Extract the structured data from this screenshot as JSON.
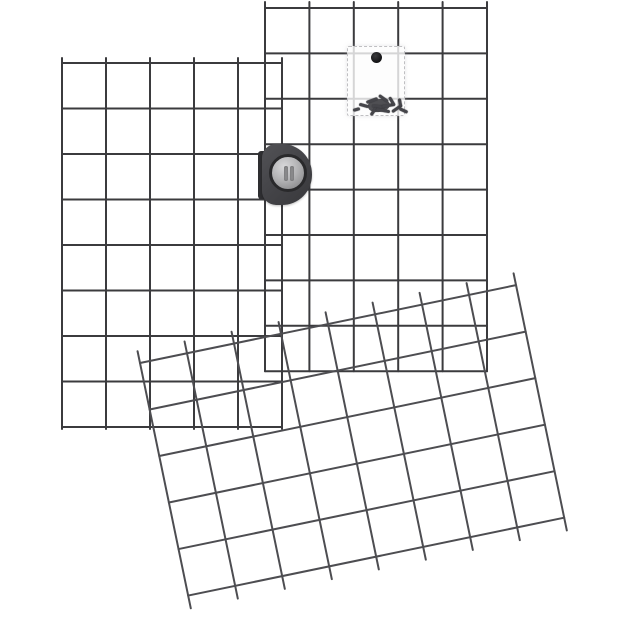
{
  "scene": {
    "type": "product-photo",
    "background_color": "#ffffff",
    "description": "Three dark-gray welded wire grid panels: two upright portrait panels side by side joined by a connector clip, and one landscape panel tilted across the lower front; a translucent bag of screws hangs on the upper-right panel."
  },
  "panels": [
    {
      "id": "grid-panel-left",
      "orientation": "portrait-upright",
      "cols": 5,
      "rows": 8,
      "x": 62,
      "y": 63,
      "cell_w": 44,
      "cell_h": 45.5,
      "rotation": 0,
      "top_stub": 5,
      "bottom_stub": 2,
      "wire_color": "#3b3b3e",
      "wire_width": 2
    },
    {
      "id": "grid-panel-right",
      "orientation": "portrait-upright",
      "cols": 5,
      "rows": 8,
      "x": 265,
      "y": 8,
      "cell_w": 44.4,
      "cell_h": 45.4,
      "rotation": 0,
      "top_stub": 6,
      "bottom_stub": 0,
      "wire_color": "#3b3b3e",
      "wire_width": 2
    },
    {
      "id": "grid-panel-tilted",
      "orientation": "landscape-tilted",
      "cols": 8,
      "rows": 5,
      "x": 140,
      "y": 363,
      "cell_w": 48,
      "cell_h": 47.5,
      "rotation": -11.7,
      "top_stub": 12,
      "bottom_stub": 13,
      "wire_color": "#4d4d51",
      "wire_width": 2
    }
  ],
  "connector_clip": {
    "body_color": "#454549",
    "plate_color": "#2e2e31",
    "knob_color": "#b4b4b6",
    "slot_color": "#8b8b8d"
  },
  "hardware_bag": {
    "bag_color": "rgba(252,252,252,0.80)",
    "hole_color": "#121214",
    "screw_color": "#45454a",
    "screws": [
      {
        "x": 11,
        "y": 57,
        "len": 10,
        "angle": 15
      },
      {
        "x": 18,
        "y": 52,
        "len": 12,
        "angle": -20
      },
      {
        "x": 24,
        "y": 58,
        "len": 13,
        "angle": 5
      },
      {
        "x": 30,
        "y": 50,
        "len": 11,
        "angle": 35
      },
      {
        "x": 34,
        "y": 57,
        "len": 12,
        "angle": -10
      },
      {
        "x": 39,
        "y": 53,
        "len": 10,
        "angle": 60
      },
      {
        "x": 43,
        "y": 60,
        "len": 12,
        "angle": -35
      },
      {
        "x": 21,
        "y": 63,
        "len": 9,
        "angle": -55
      },
      {
        "x": 28,
        "y": 62,
        "len": 14,
        "angle": 10
      },
      {
        "x": 48,
        "y": 54,
        "len": 8,
        "angle": 80
      },
      {
        "x": 5,
        "y": 61,
        "len": 7,
        "angle": -15
      },
      {
        "x": 51,
        "y": 62,
        "len": 9,
        "angle": 25
      }
    ]
  }
}
